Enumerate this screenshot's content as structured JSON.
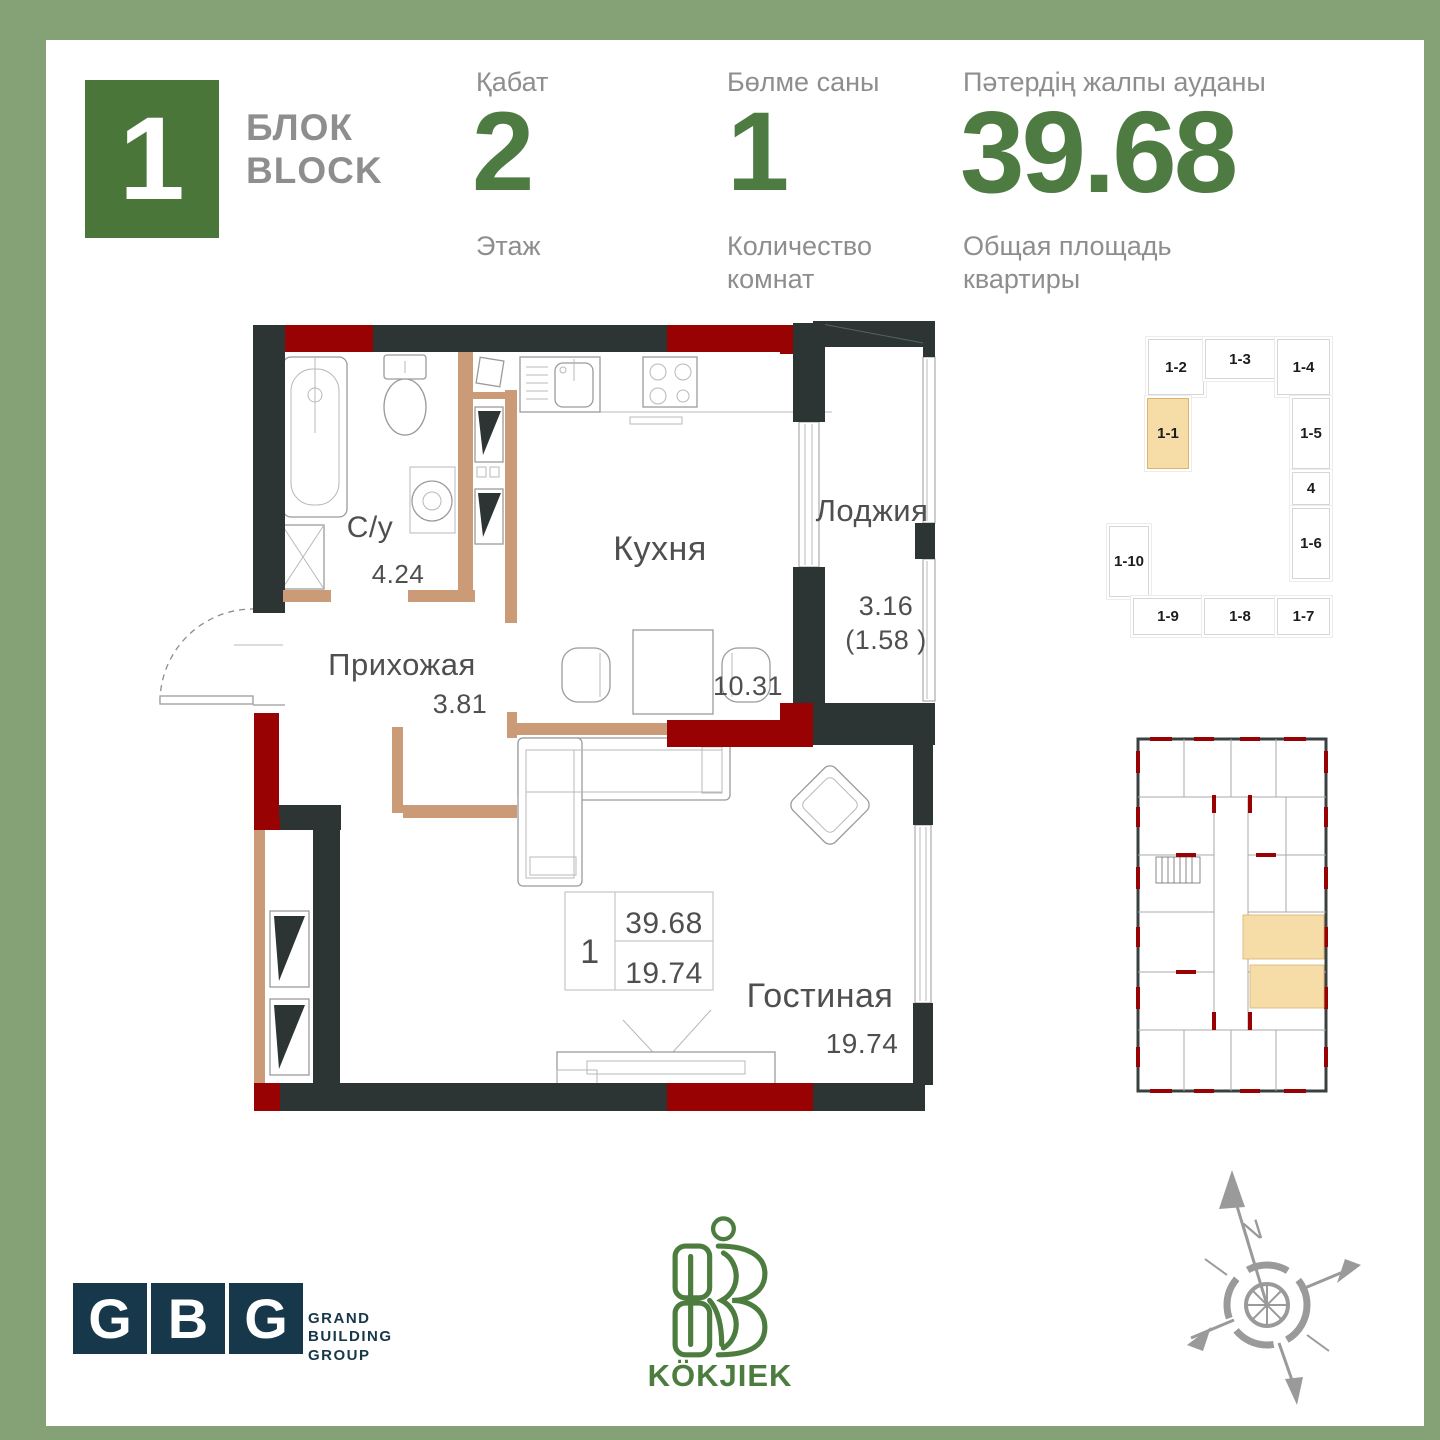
{
  "header": {
    "block_badge": "1",
    "block_label_kk": "БЛОК",
    "block_label_en": "BLOCK",
    "floor": {
      "label_kk": "Қабат",
      "value": "2",
      "label_ru": "Этаж"
    },
    "rooms": {
      "label_kk": "Бөлме саны",
      "value": "1",
      "label_ru_1": "Количество",
      "label_ru_2": "комнат"
    },
    "area": {
      "label_kk": "Пәтердің жалпы ауданы",
      "value": "39.68",
      "label_ru_1": "Общая площадь",
      "label_ru_2": "квартиры"
    }
  },
  "floor_plan": {
    "rooms": [
      {
        "name": "С/у",
        "area": "4.24"
      },
      {
        "name": "Кухня",
        "area": "10.31"
      },
      {
        "name": "Лоджия",
        "area": "3.16",
        "area_reduced": "(1.58 )"
      },
      {
        "name": "Прихожая",
        "area": "3.81"
      },
      {
        "name": "Гостиная",
        "area": "19.74"
      }
    ],
    "stamp": {
      "rooms": "1",
      "total_area": "39.68",
      "living_area": "19.74"
    }
  },
  "unit_selector": {
    "highlighted": "1-1",
    "units": [
      "1-2",
      "1-3",
      "1-4",
      "1-1",
      "1-5",
      "4",
      "1-6",
      "1-10",
      "1-9",
      "1-8",
      "1-7"
    ]
  },
  "footer": {
    "gbg": {
      "letters": [
        "G",
        "B",
        "G"
      ],
      "caption_1": "GRAND",
      "caption_2": "BUILDING",
      "caption_3": "GROUP"
    },
    "kokjiek": {
      "name": "KÖKJIEK"
    },
    "compass": {
      "north_label": "N"
    }
  },
  "colors": {
    "frame_green": "#84A276",
    "badge_green": "#4B7639",
    "number_green": "#4D7B42",
    "wall_dark": "#2D3534",
    "wall_red": "#990202",
    "wall_tan": "#CB9B78",
    "highlight": "#F6DCA7",
    "gbg_navy": "#17384A",
    "logo_green": "#4C7D3F"
  }
}
